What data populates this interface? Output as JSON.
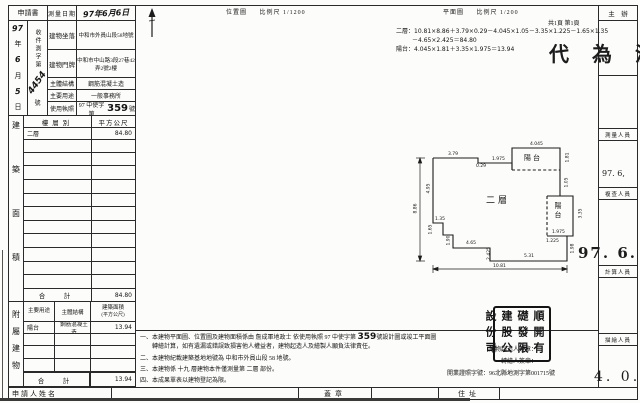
{
  "form": {
    "application": "申請書",
    "survey_date_label": "測量日期",
    "survey_date_value": "97年6月6日",
    "receipt_date_chars": [
      "97",
      "年",
      "6",
      "月",
      "5",
      "日"
    ],
    "receipt_no_label": "收件測字第",
    "receipt_no_value": "4454",
    "receipt_no_suffix": "號",
    "rows": [
      {
        "label": "建物坐落",
        "value": "中和市外員山段58地號"
      },
      {
        "label": "建物門牌",
        "value": "中和市中山路3段27巷42弄2號2樓"
      },
      {
        "label": "主體結構",
        "value": "鋼筋混凝土造"
      },
      {
        "label": "主要用途",
        "value": "一般事務所"
      },
      {
        "label": "使用執照",
        "prefix": "97 中使字第",
        "number": "359",
        "suffix": "號"
      }
    ]
  },
  "area_table": {
    "side_label": "建築面積",
    "header_floor": "樓層別",
    "header_area": "平方公尺",
    "row_floor": "二層",
    "row_area": "84.80",
    "total_label": "合　計",
    "total_value": "84.80"
  },
  "annex_table": {
    "side_label": "附屬建物",
    "header_use": "主要用途",
    "header_structure": "主體結構",
    "header_area1": "建築面積",
    "header_area2": "(平方公尺)",
    "row_use": "陽台",
    "row_structure": "鋼筋混凝土造",
    "row_area": "13.94",
    "total_label": "合　計",
    "total_value": "13.94"
  },
  "applicant": {
    "name_label": "申請人姓名",
    "seal_label": "蓋章",
    "address_label": "住址"
  },
  "location_map": {
    "title": "位置圖",
    "scale": "比例尺 1/1200"
  },
  "plan": {
    "title": "平面圖",
    "scale": "比例尺 1/200",
    "pages": "共1頁 第1頁",
    "formula_line1": "二層：10.81×8.86＋3.79×0.29－4.045×1.05－3.35×1.225－1.65×1.35",
    "formula_line2": "－4.65×2.425＝84.80",
    "formula_line3": "陽台：4.045×1.81＋3.35×1.975＝13.94",
    "labels": {
      "main": "二層",
      "balcony_top": "陽台",
      "balcony_right": "陽台"
    },
    "dimensions": [
      {
        "t": "3.79",
        "x": 48,
        "y": 14
      },
      {
        "t": "0.29",
        "x": 76,
        "y": 26
      },
      {
        "t": "1.975",
        "x": 92,
        "y": 19
      },
      {
        "t": "4.045",
        "x": 130,
        "y": 4
      },
      {
        "t": "1.81",
        "x": 163,
        "y": 17,
        "r": 1
      },
      {
        "t": "1.05",
        "x": 162,
        "y": 42,
        "r": 1
      },
      {
        "t": "3.35",
        "x": 176,
        "y": 73,
        "r": 1
      },
      {
        "t": "1.975",
        "x": 152,
        "y": 92
      },
      {
        "t": "1.225",
        "x": 146,
        "y": 101
      },
      {
        "t": "1.98",
        "x": 168,
        "y": 108,
        "r": 1
      },
      {
        "t": "8.86",
        "x": 11,
        "y": 68,
        "r": 1
      },
      {
        "t": "4.95",
        "x": 24,
        "y": 48,
        "r": 1
      },
      {
        "t": "1.35",
        "x": 35,
        "y": 79
      },
      {
        "t": "1.65",
        "x": 26,
        "y": 89,
        "r": 1
      },
      {
        "t": "1.90",
        "x": 44,
        "y": 100,
        "r": 1
      },
      {
        "t": "4.65",
        "x": 66,
        "y": 103
      },
      {
        "t": "2.425",
        "x": 83,
        "y": 113,
        "r": 1
      },
      {
        "t": "5.31",
        "x": 124,
        "y": 116
      },
      {
        "t": "10.81",
        "x": 93,
        "y": 126
      }
    ]
  },
  "officials": {
    "chief_label": "主　辦",
    "roles": [
      "測量人員",
      "複查人員",
      "計算人員",
      "描繪人員"
    ],
    "stamps": {
      "approval": "代 為 決",
      "date_small": "97. 6,",
      "date_large": "97. 6.",
      "date_bottom": "4. 0."
    }
  },
  "notes": {
    "line1_pre": "一、本建物平面圖、位置圖及建物面積係由 詹成軍地政士 依使用執照 97 中使字第 ",
    "line1_num": "359",
    "line1_post": "號設計圖或竣工平面圖",
    "line1_cont": "轉繪計算，如有遺漏或錯誤致損害他人權益者，建物起造人及繪製人願負法律責任。",
    "line2": "二、本建物紀載建築基地地號為 中和市外員山段 58 地號。",
    "line3": "三、本建物係 十九 層建物本件僅測量第 二層 部份。",
    "line4": "四、本成果單表以建物登記為限。"
  },
  "signatures": {
    "builder_label": "建物起造人簽章：",
    "drafter_label": "轉繪人簽章：",
    "license_label": "開業證照字號：",
    "license_value": "96北縣地測字第001715號",
    "seal_col1": "順礎建設",
    "seal_col2": "開發股份",
    "seal_col3": "有限公司"
  }
}
